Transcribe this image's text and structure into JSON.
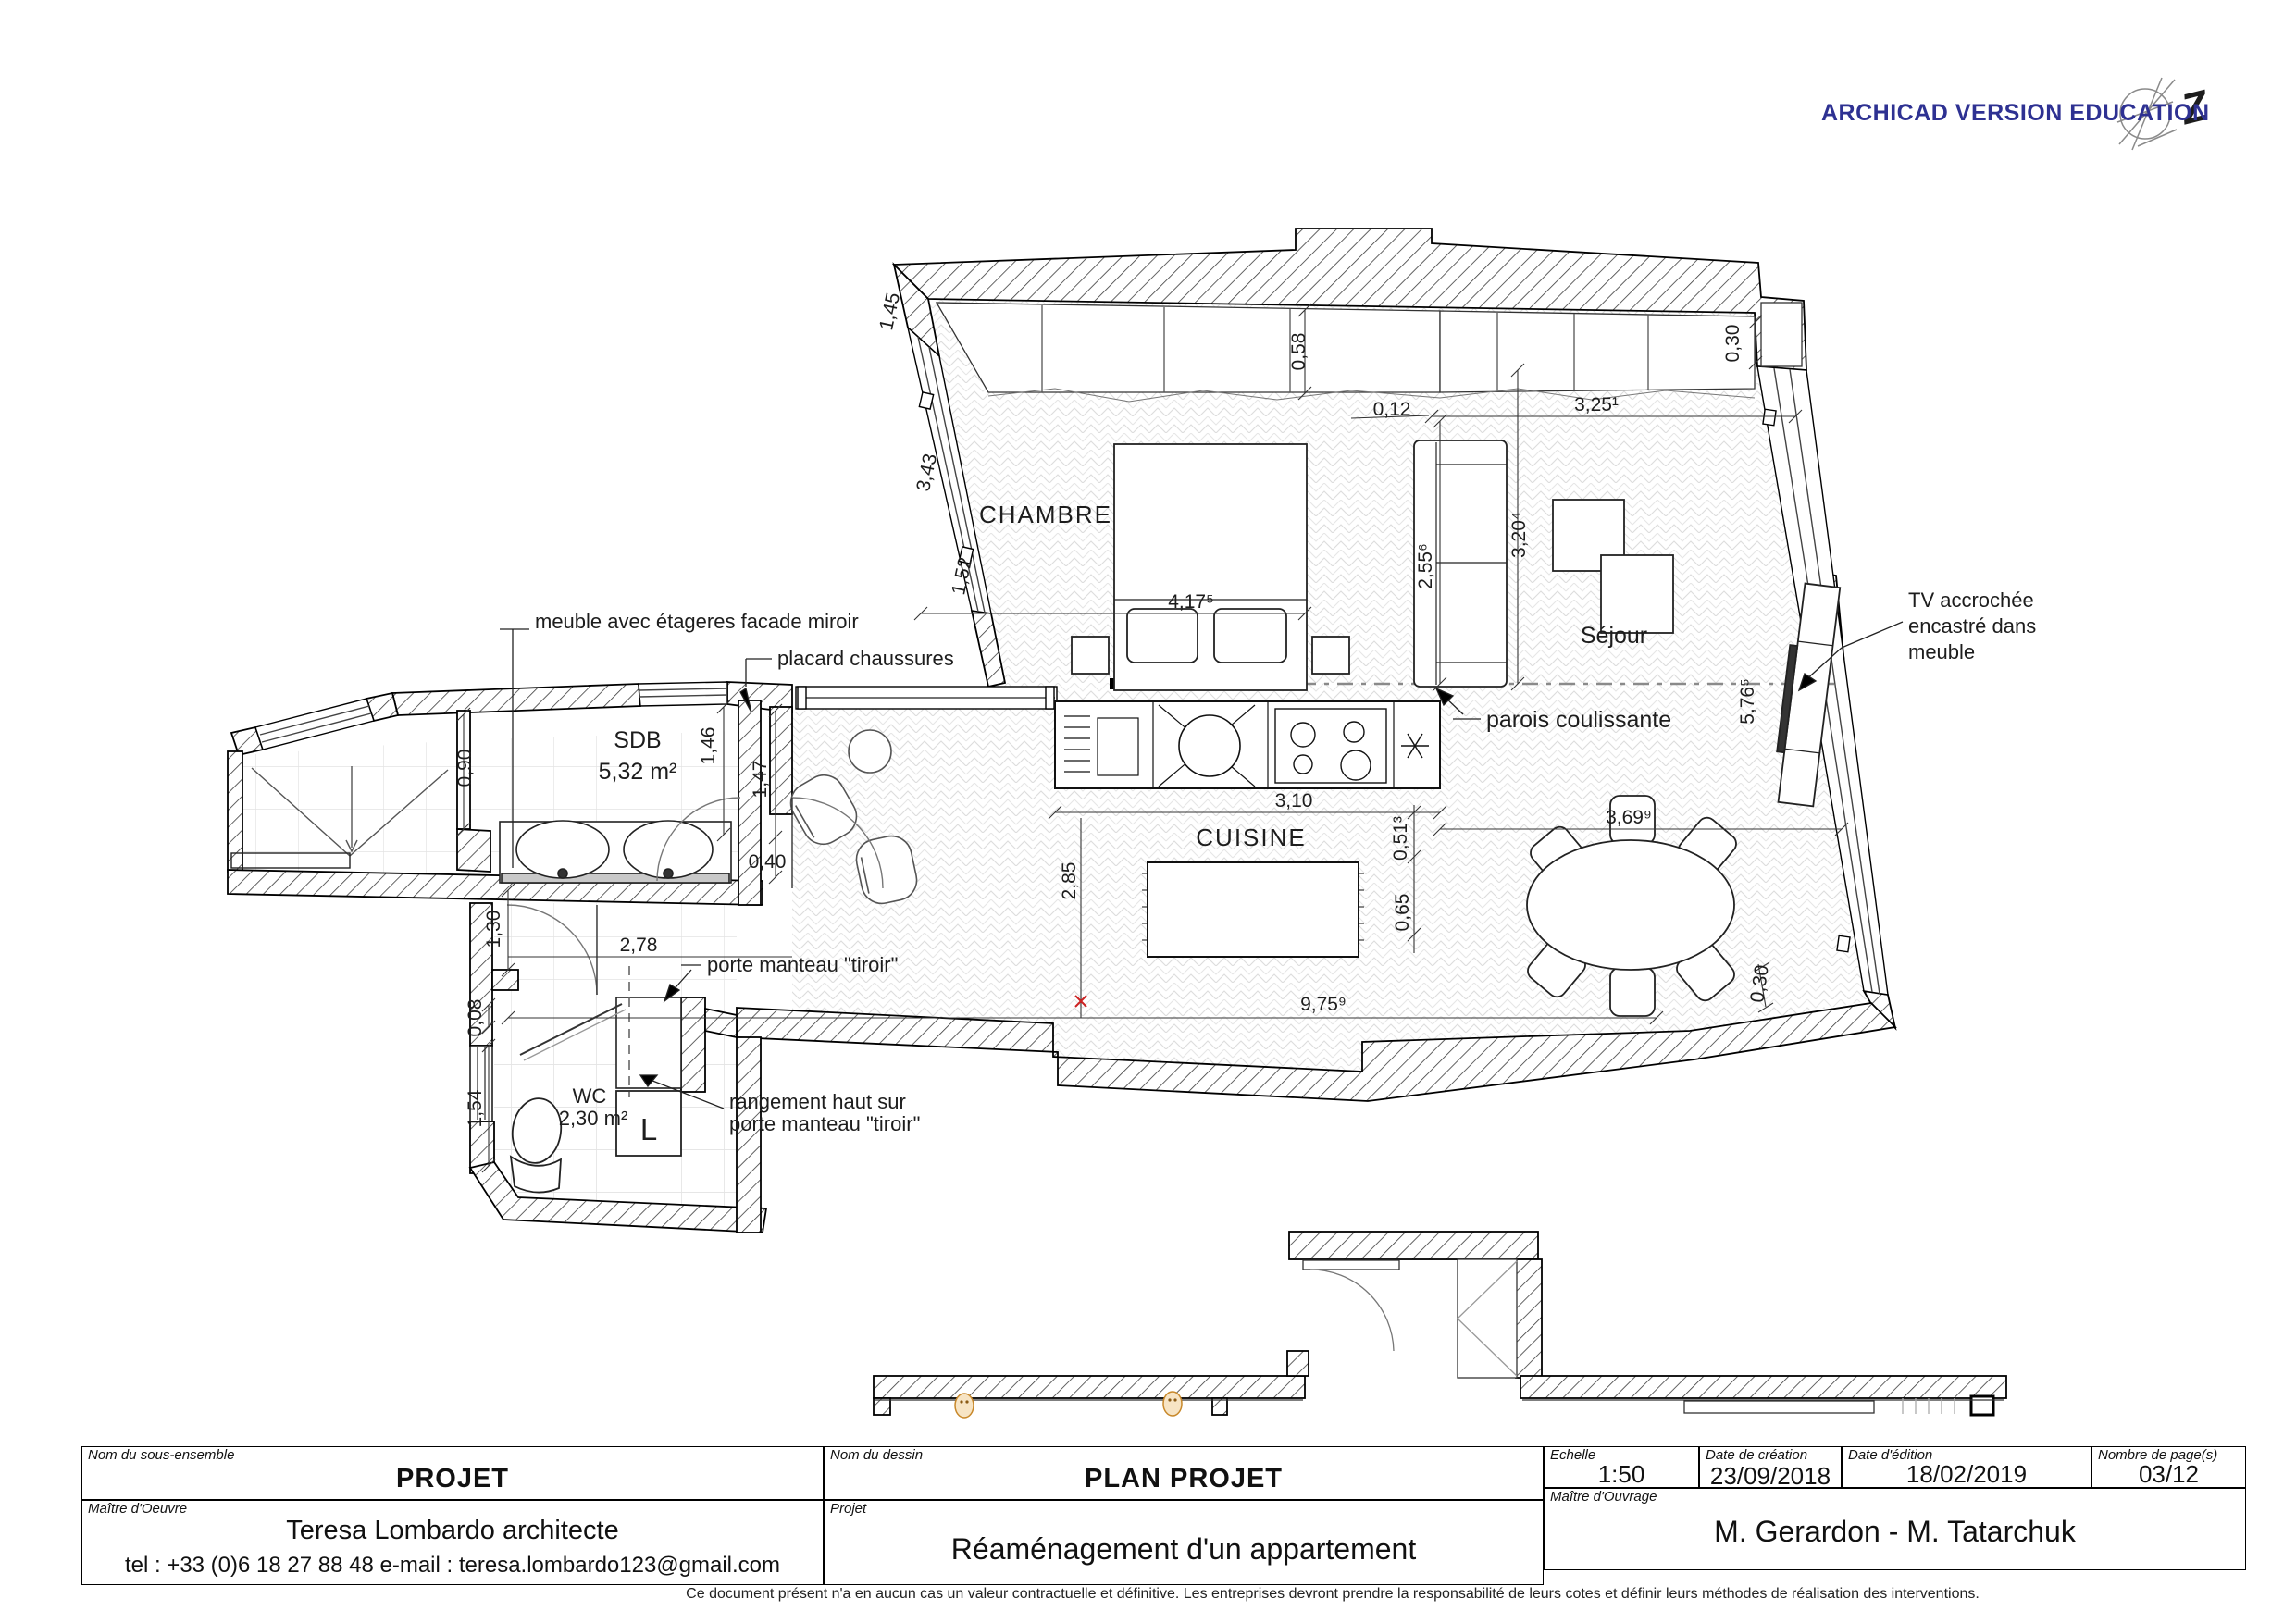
{
  "watermark": {
    "text": "ARCHICAD VERSION EDUCATION",
    "color": "#2e3192",
    "logo_glyph": "Z"
  },
  "plan": {
    "rooms": {
      "chambre": "CHAMBRE",
      "sejour": "Séjour",
      "cuisine": "CUISINE",
      "sdb_name": "SDB",
      "sdb_area": "5,32 m²",
      "wc_name": "WC",
      "wc_area": "2,30 m²",
      "appliance_l": "L"
    },
    "annotations": {
      "meuble_miroir": "meuble avec étageres facade miroir",
      "placard_chaussures": "placard chaussures",
      "porte_manteau": "porte manteau \"tiroir\"",
      "rangement_haut_1": "rangement haut sur",
      "rangement_haut_2": "porte manteau \"tiroir\"",
      "parois": "parois coulissante",
      "tv_1": "TV accrochée",
      "tv_2": "encastré dans",
      "tv_3": "meuble"
    },
    "dims": {
      "d058": "0,58",
      "d012": "0,12",
      "d325": "3,25¹",
      "d030_top": "0,30",
      "d255": "2,55⁶",
      "d320": "3,20⁴",
      "d417": "4,17⁵",
      "d145": "1,45",
      "d343": "3,43",
      "d152": "1,52",
      "d090": "0,90",
      "d146": "1,46",
      "d147": "1,47",
      "d040": "0,40",
      "d130": "1,30",
      "d278": "2,78",
      "d008": "0,08",
      "d154": "1,54",
      "d285": "2,85",
      "d310": "3,10",
      "d0513": "0,51³",
      "d065": "0,65",
      "d975": "9,75⁹",
      "d369": "3,69⁹",
      "d576": "5,76⁵",
      "d030_bottom": "0,30"
    }
  },
  "title_block": {
    "nom_sous_ensemble_label": "Nom du sous-ensemble",
    "nom_sous_ensemble_value": "PROJET",
    "nom_dessin_label": "Nom du dessin",
    "nom_dessin_value": "PLAN PROJET",
    "echelle_label": "Echelle",
    "echelle_value": "1:50",
    "date_creation_label": "Date de création",
    "date_creation_value": "23/09/2018",
    "date_edition_label": "Date d'édition",
    "date_edition_value": "18/02/2019",
    "pages_label": "Nombre de page(s)",
    "pages_value": "03/12",
    "maitre_oeuvre_label": "Maître d'Oeuvre",
    "maitre_oeuvre_name": "Teresa Lombardo architecte",
    "maitre_oeuvre_contact": "tel : +33 (0)6 18 27 88 48  e-mail : teresa.lombardo123@gmail.com",
    "projet_label": "Projet",
    "projet_value": "Réaménagement d'un appartement",
    "maitre_ouvrage_label": "Maître d'Ouvrage",
    "maitre_ouvrage_value": "M. Gerardon - M. Tatarchuk",
    "disclaimer": "Ce document présent n'a en aucun cas un valeur contractuelle et définitive. Les entreprises devront prendre la responsabilité de leurs cotes et définir leurs méthodes de réalisation des interventions."
  }
}
